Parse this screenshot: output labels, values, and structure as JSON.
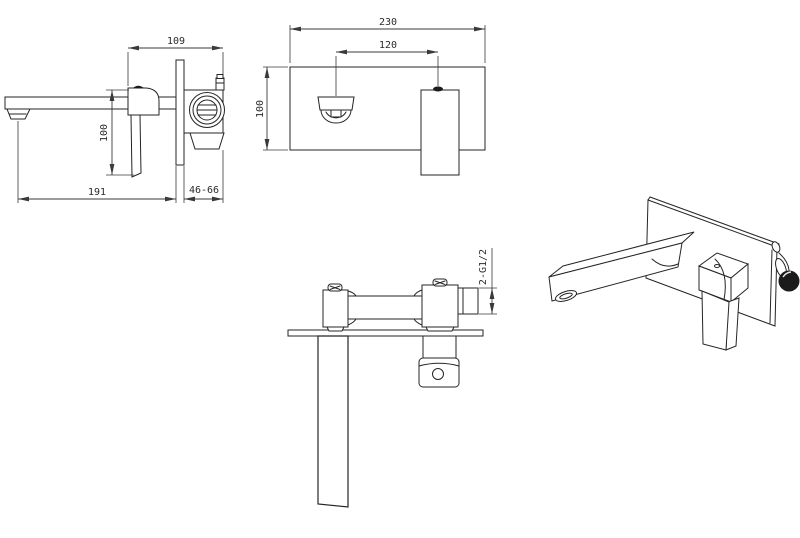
{
  "colors": {
    "line": "#252525",
    "background": "#ffffff",
    "dimension_text": "#2a2a2a"
  },
  "views": {
    "side_view": {
      "dimensions": {
        "body_depth": "109",
        "height": "100",
        "spout_reach": "191",
        "wall_embed_range": "46-66"
      }
    },
    "front_view": {
      "dimensions": {
        "plate_width": "230",
        "spout_to_handle_spacing": "120",
        "plate_height": "100"
      }
    },
    "top_view": {
      "dimensions": {
        "thread_spec": "2-G1/2"
      }
    },
    "perspective_view": {}
  }
}
